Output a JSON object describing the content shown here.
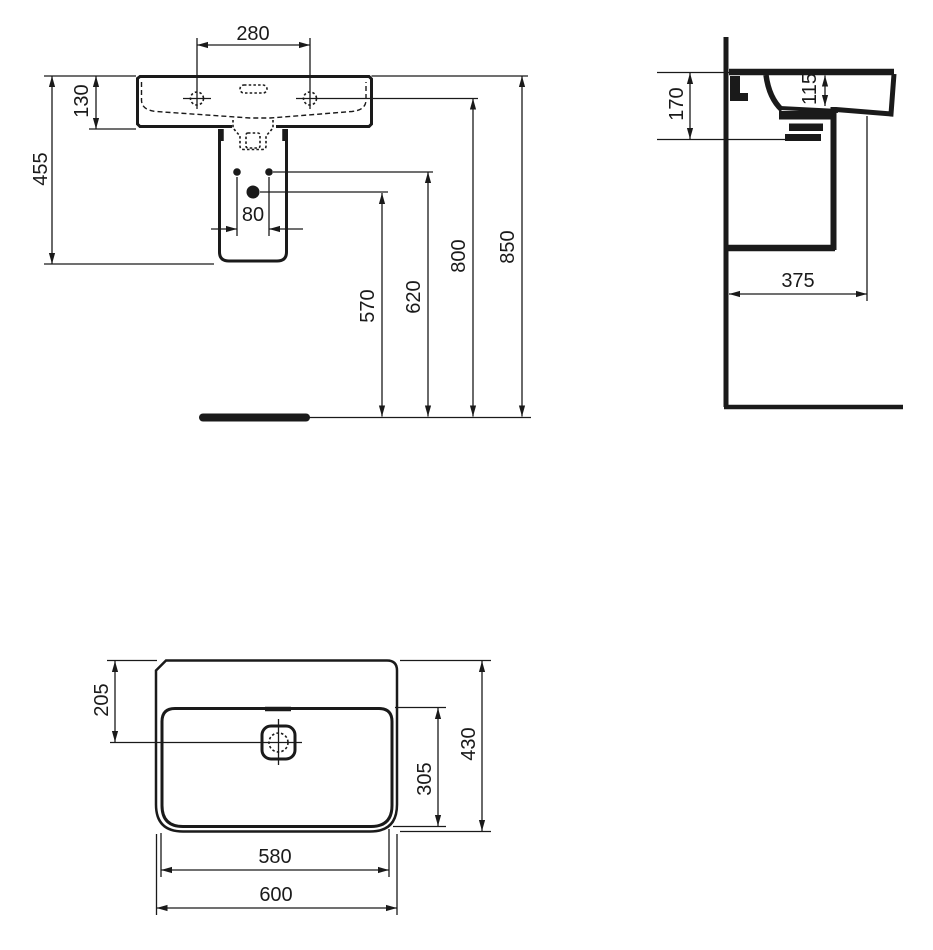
{
  "drawing": {
    "type": "technical-dimension-drawing",
    "subject": "washbasin with semi-pedestal, three orthographic views",
    "colors": {
      "line": "#1a1a1a",
      "background": "#ffffff"
    },
    "front_view": {
      "labels": {
        "tap_hole_spacing": "280",
        "rim_to_bowl_bottom": "130",
        "basin_with_pedestal_height": "455",
        "fixing_hole_spacing": "80",
        "drain_outlet_height": "570",
        "fixing_holes_height": "620",
        "tap_hole_height": "800",
        "rim_height": "850"
      }
    },
    "side_view": {
      "labels": {
        "profile_height": "170",
        "bowl_inner_depth": "115",
        "wall_to_front": "375"
      }
    },
    "plan_view": {
      "labels": {
        "back_to_drain_center": "205",
        "bowl_inner_depth": "305",
        "total_depth": "430",
        "bowl_inner_width": "580",
        "total_width": "600"
      }
    }
  }
}
